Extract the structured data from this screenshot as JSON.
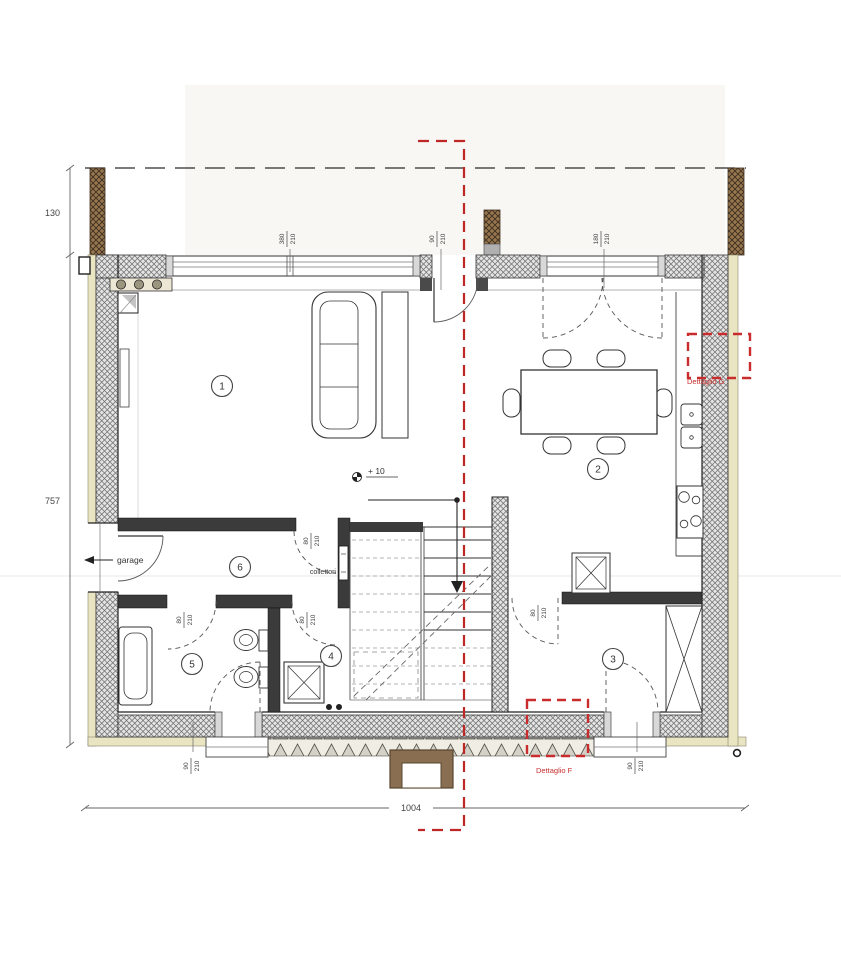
{
  "plan": {
    "rooms": [
      "1",
      "2",
      "3",
      "4",
      "5",
      "6"
    ],
    "annotations": {
      "garage": "garage",
      "collettori": "collettori",
      "level": "+ 10"
    },
    "details": {
      "right": "Dettaglio G",
      "bottom": "Dettaglio F"
    },
    "overall": {
      "height_upper": "130",
      "height_main": "757",
      "width_total": "1004"
    },
    "openings": [
      {
        "id": "living-window",
        "width": "380",
        "height": "210"
      },
      {
        "id": "entry-door",
        "width": "90",
        "height": "210"
      },
      {
        "id": "kitchen-window",
        "width": "180",
        "height": "210"
      },
      {
        "id": "hall-door",
        "width": "80",
        "height": "210"
      },
      {
        "id": "bath-door",
        "width": "80",
        "height": "210"
      },
      {
        "id": "shower-room-door",
        "width": "80",
        "height": "210"
      },
      {
        "id": "room3-door",
        "width": "80",
        "height": "210"
      },
      {
        "id": "bath-ext-door",
        "width": "90",
        "height": "210"
      },
      {
        "id": "room3-ext-door",
        "width": "90",
        "height": "210"
      }
    ],
    "colors": {
      "section_line": "#bf2626",
      "detail_box": "#c92c2c",
      "insulation": "#e9e5c3",
      "wall_hatch_bg": "#e4e4e4",
      "column_brown": "#97764f"
    }
  }
}
